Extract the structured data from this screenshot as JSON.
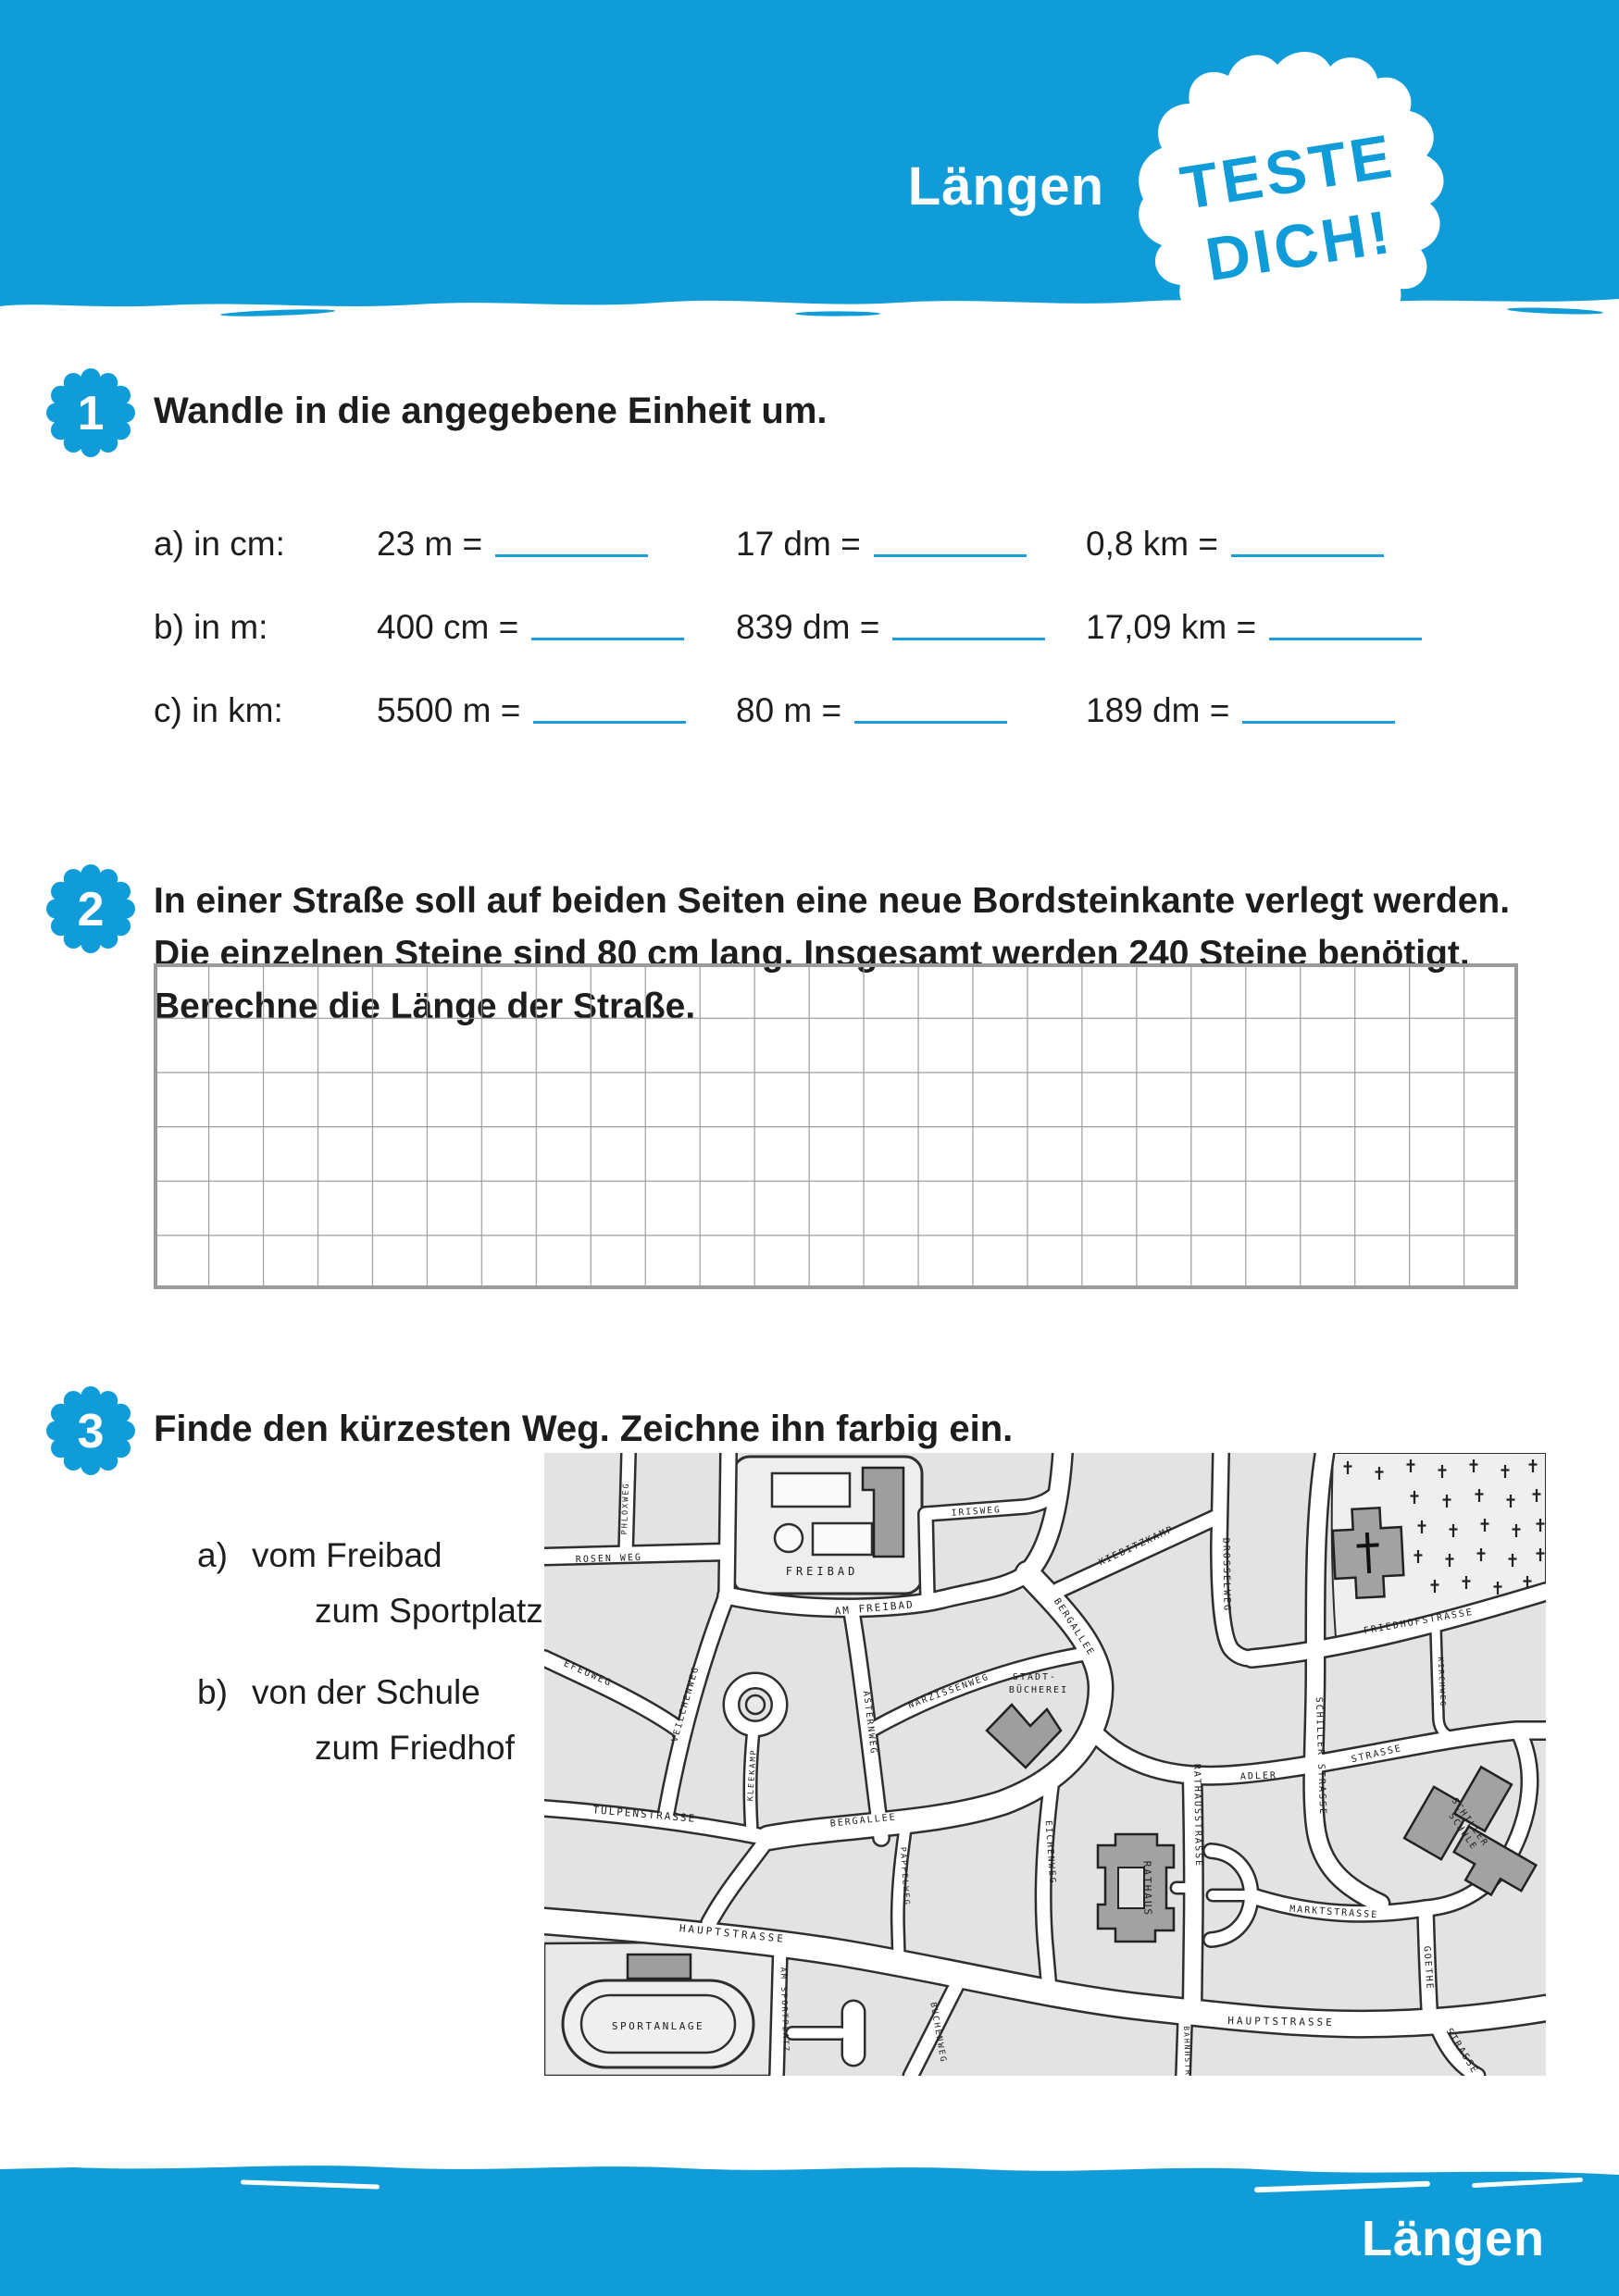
{
  "header": {
    "title": "Längen",
    "badge": [
      "TESTE",
      "DICH!"
    ]
  },
  "footer": {
    "title": "Längen"
  },
  "colors": {
    "accent_blue": "#0f9cd8",
    "blank_line_blue": "#1b9ed9",
    "grid_gray": "#9b9b9b"
  },
  "tasks": [
    {
      "number": "1",
      "title": "Wandle in die angegebene Einheit um.",
      "rows": [
        {
          "label": "a) in cm:",
          "items": [
            "23 m =",
            "17 dm =",
            "0,8 km ="
          ]
        },
        {
          "label": "b) in m:",
          "items": [
            "400 cm =",
            "839 dm =",
            "17,09 km ="
          ]
        },
        {
          "label": "c) in km:",
          "items": [
            "5500 m =",
            "80 m =",
            "189 dm ="
          ]
        }
      ]
    },
    {
      "number": "2",
      "lines": [
        "In einer Straße soll auf beiden Seiten eine neue Bordsteinkante verlegt werden.",
        "Die einzelnen Steine sind 80 cm lang. Insgesamt werden 240 Steine benötigt.",
        "Berechne die Länge der Straße."
      ],
      "grid": {
        "rows": 6,
        "cols": 25
      }
    },
    {
      "number": "3",
      "title": "Finde den kürzesten Weg. Zeichne ihn farbig ein.",
      "subtasks": [
        {
          "label": "a)",
          "line1": "vom Freibad",
          "line2": "zum Sportplatz"
        },
        {
          "label": "b)",
          "line1": "von der Schule",
          "line2": "zum Friedhof"
        }
      ]
    }
  ],
  "map": {
    "labels": {
      "rosenweg": "ROSEN WEG",
      "phloxweg": "PHLOXWEG",
      "freibad": "FREIBAD",
      "am_freibad": "AM FREIBAD",
      "irisweg": "IRISWEG",
      "efeuweg": "EFEUWEG",
      "veilchenweg": "VEILCHENWEG",
      "kleekamp": "KLEEKAMP",
      "asternweg": "ASTERNWEG",
      "narzissenweg": "NARZISSENWEG",
      "stadtbuecherei_1": "STADT-",
      "stadtbuecherei_2": "BÜCHEREI",
      "tulpenstrasse": "TULPENSTRASSE",
      "bergallee_upper": "BERGALLEE",
      "bergallee_lower": "BERGALLEE",
      "kiebitzkamp": "KIEBITZKAMP",
      "drosselweg": "DROSSELWEG",
      "friedhofstrasse": "FRIEDHOFSTRASSE",
      "kirchweg": "KIRCHWEG",
      "schillerstrasse": "SCHILLER STRASSE",
      "adler": "ADLER",
      "adler_strasse2": "STRASSE",
      "rathausstrasse": "RATHAUSSTRASSE",
      "rathaus": "RATHAUS",
      "marktstrasse": "MARKTSTRASSE",
      "schillerschule_1": "SCHILLER",
      "schillerschule_2": "SCHULE",
      "goethe": "GOETHE",
      "goethe_strasse": "STRASSE",
      "hauptstrasse_1": "HAUPTSTRASSE",
      "hauptstrasse_2": "HAUPTSTRASSE",
      "bahnhofstr": "BAHNHSTR.",
      "buchenweg": "BUCHENWEG",
      "am_sportplatz": "AM SPORTPLATZ",
      "sportanlage": "SPORTANLAGE",
      "eichenweg": "EICHENWEG",
      "pappelweg": "PAPPELWEG"
    }
  }
}
